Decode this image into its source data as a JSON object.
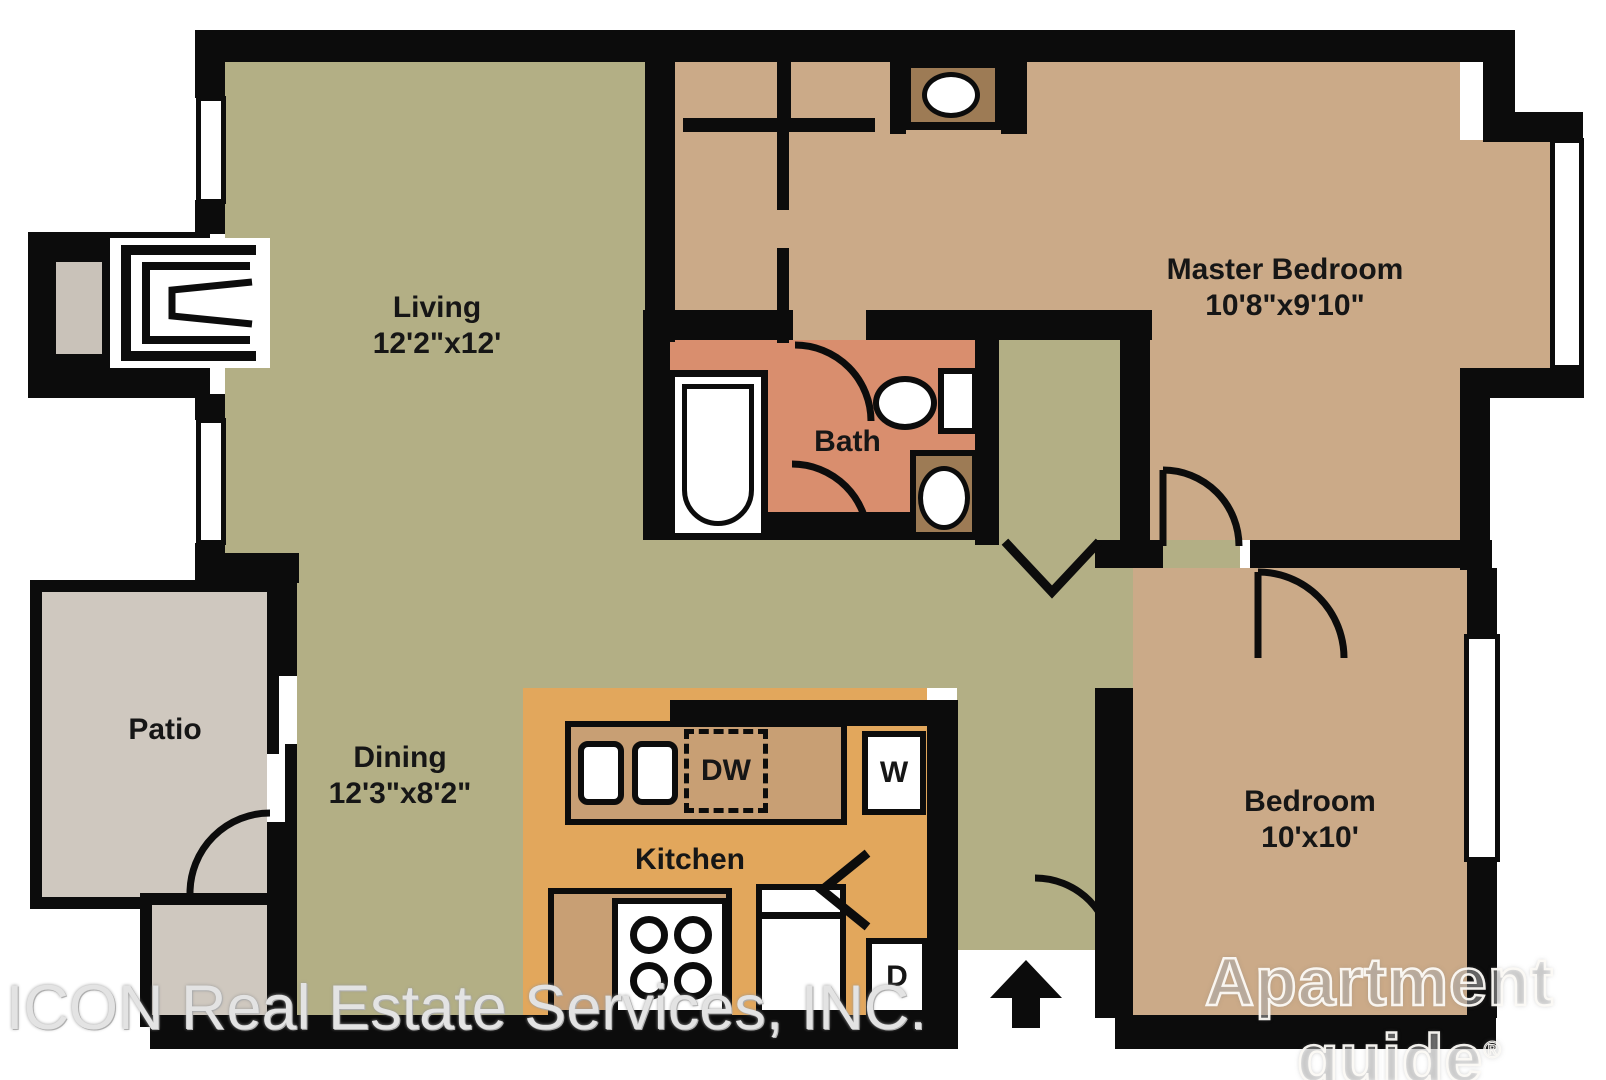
{
  "plan": {
    "rooms": {
      "living": {
        "name": "Living",
        "dims": "12'2\"x12'"
      },
      "dining": {
        "name": "Dining",
        "dims": "12'3\"x8'2\""
      },
      "master": {
        "name": "Master Bedroom",
        "dims": "10'8\"x9'10\""
      },
      "bedroom": {
        "name": "Bedroom",
        "dims": "10'x10'"
      },
      "bath": {
        "name": "Bath"
      },
      "patio": {
        "name": "Patio"
      },
      "kitchen": {
        "name": "Kitchen"
      }
    },
    "appliances": {
      "dishwasher": "DW",
      "washer": "W",
      "dryer": "D"
    },
    "colors": {
      "olive": "#b3af85",
      "tan": "#cbaa88",
      "brown": "#9d7b55",
      "salmon": "#d98e6e",
      "orange": "#e2a75c",
      "counter": "#c89f74",
      "patio": "#cfc8bf",
      "hearth": "#c9c2b9",
      "wall": "#0c0c0c"
    },
    "watermarks": {
      "realtor": "ICON Real Estate Services, INC.",
      "brand_line1": "Apartment",
      "brand_line2": "guide",
      "brand_reg": "®"
    }
  }
}
